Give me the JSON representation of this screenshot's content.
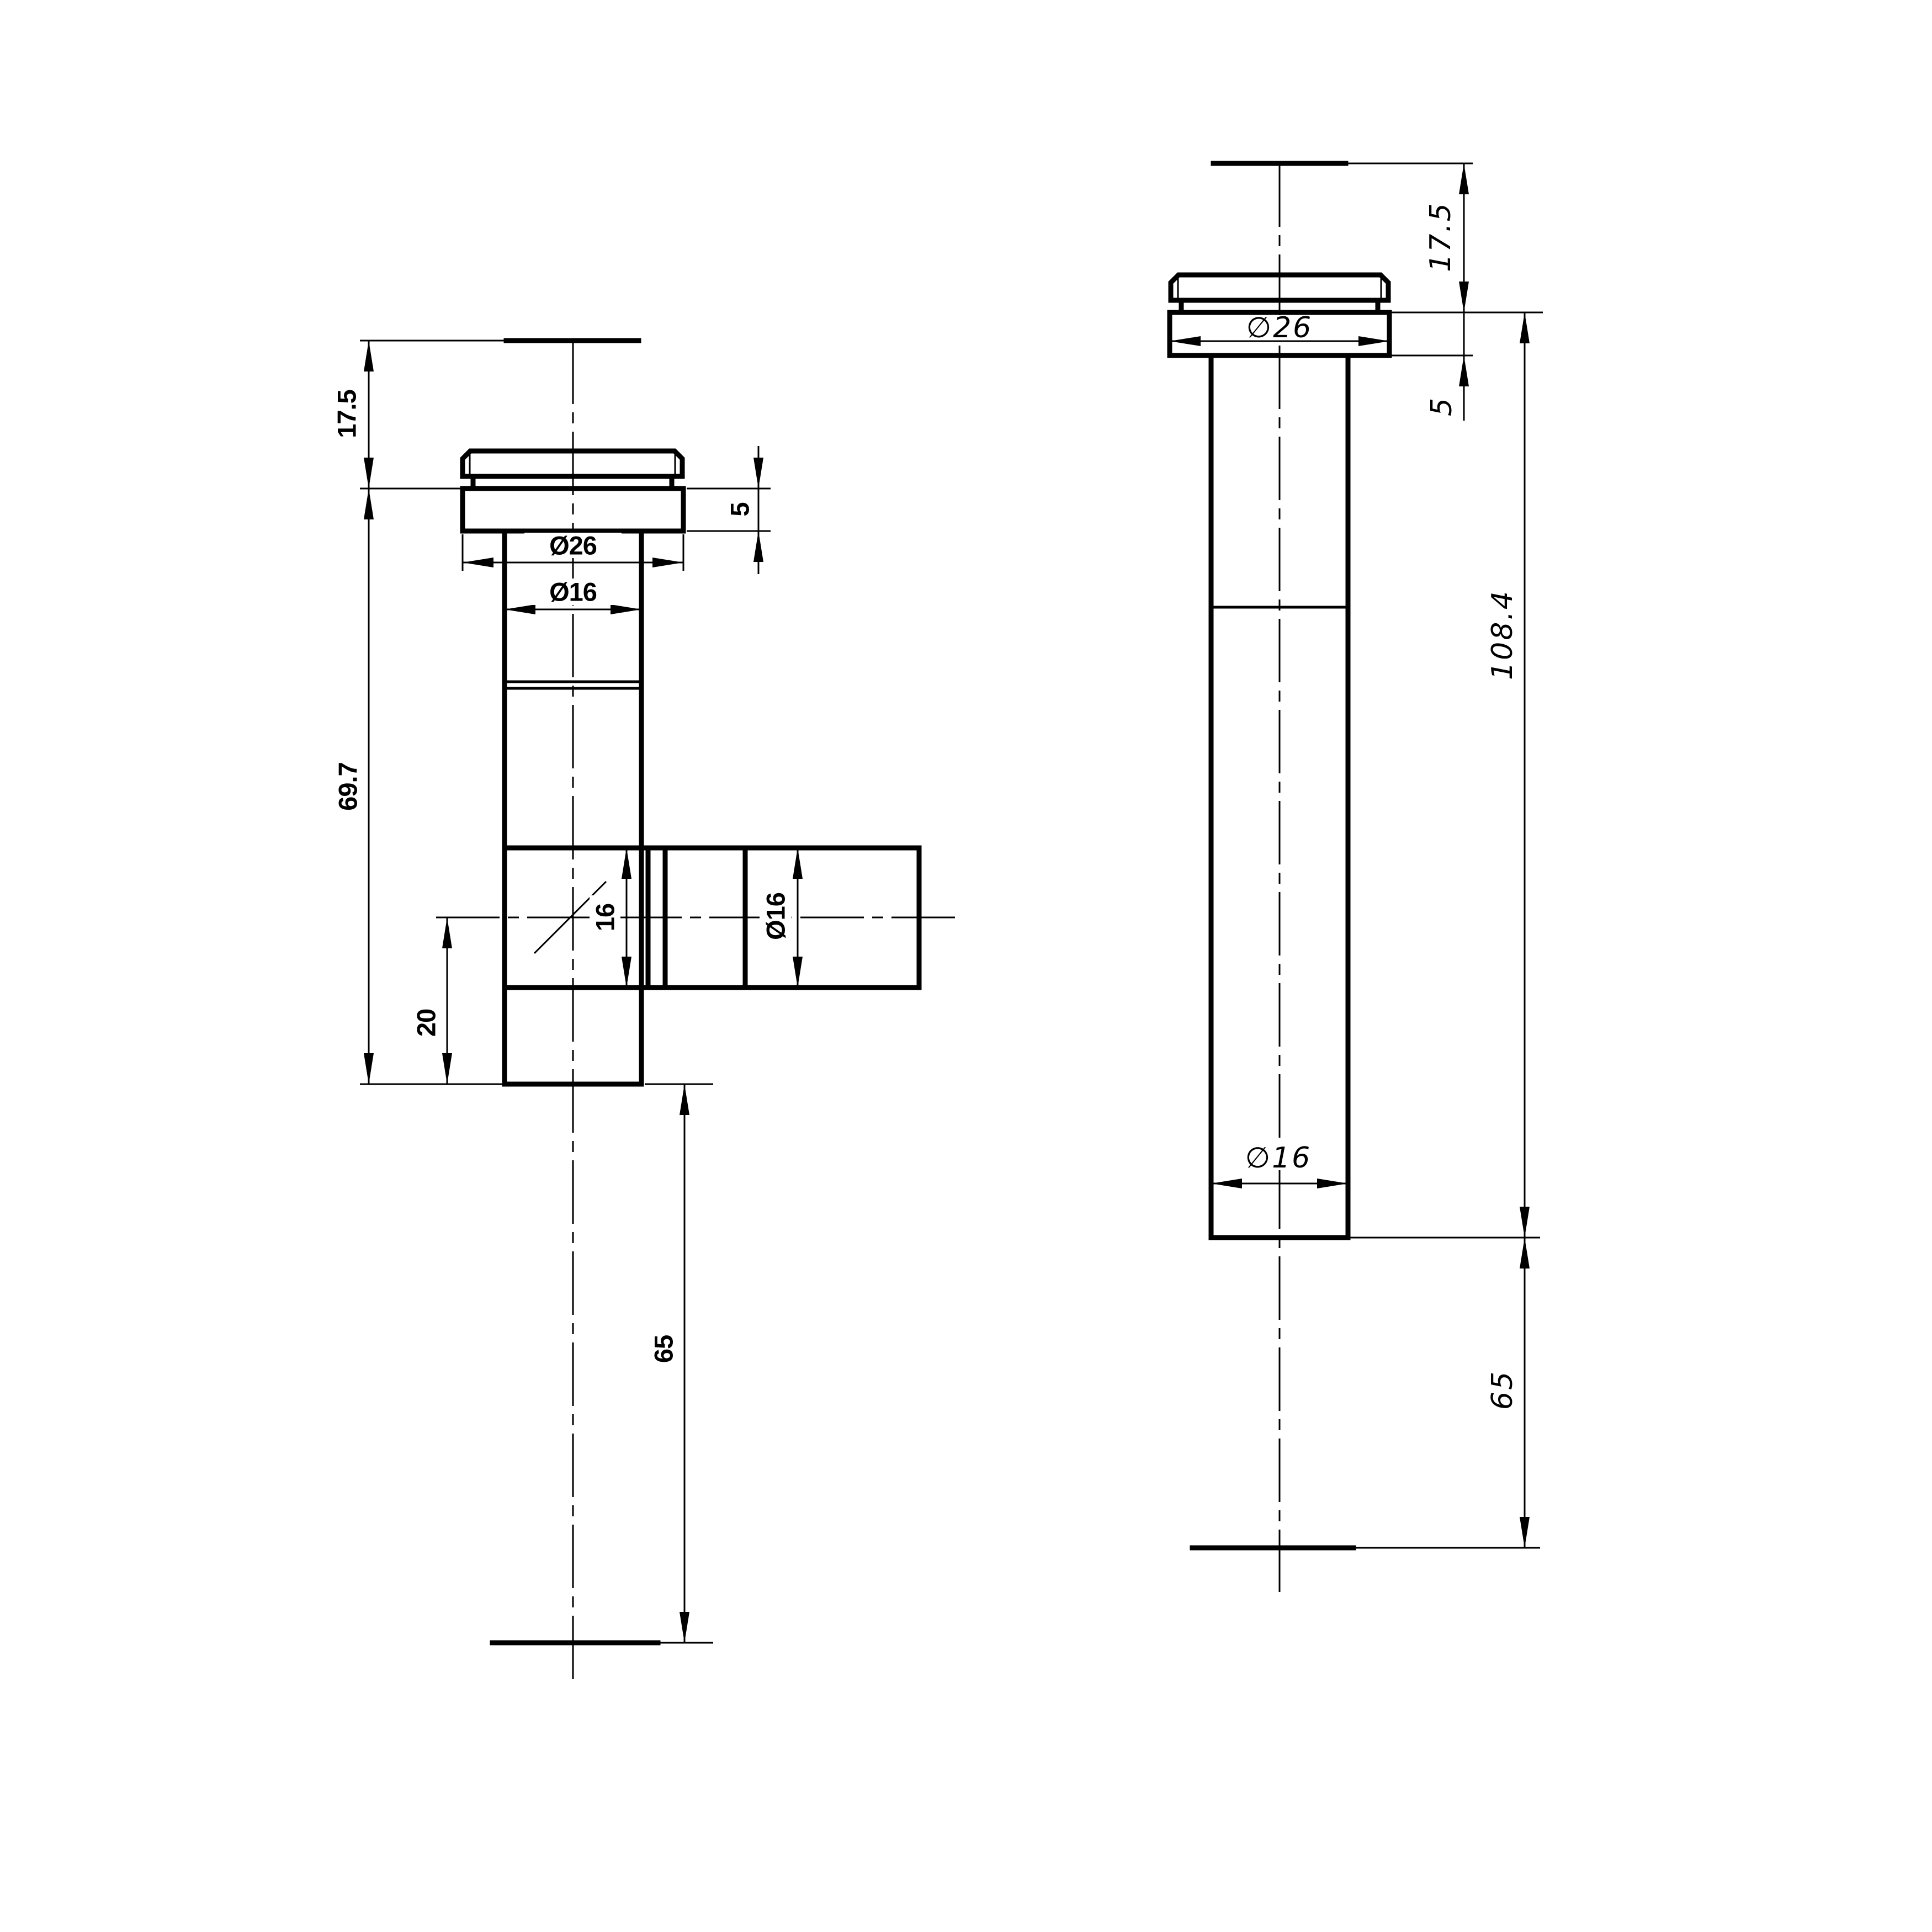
{
  "drawing": {
    "type": "technical-orthographic-drawing",
    "subject": "pipe-fitting-with-flanged-cap",
    "background": "#ffffff",
    "line_color": "#000000",
    "front_view": {
      "dims": {
        "h17_5": "17.5",
        "h69_7": "69.7",
        "h20": "20",
        "h16": "16",
        "dia16_branch": "Ø16",
        "dia26": "Ø26",
        "dia16_body": "Ø16",
        "h5": "5",
        "h65": "65"
      }
    },
    "side_view": {
      "dims": {
        "h17_5": "17.5",
        "h5": "5",
        "dia26": "∅26",
        "h108_4": "108.4",
        "dia16": "∅16",
        "h65": "65"
      }
    }
  }
}
